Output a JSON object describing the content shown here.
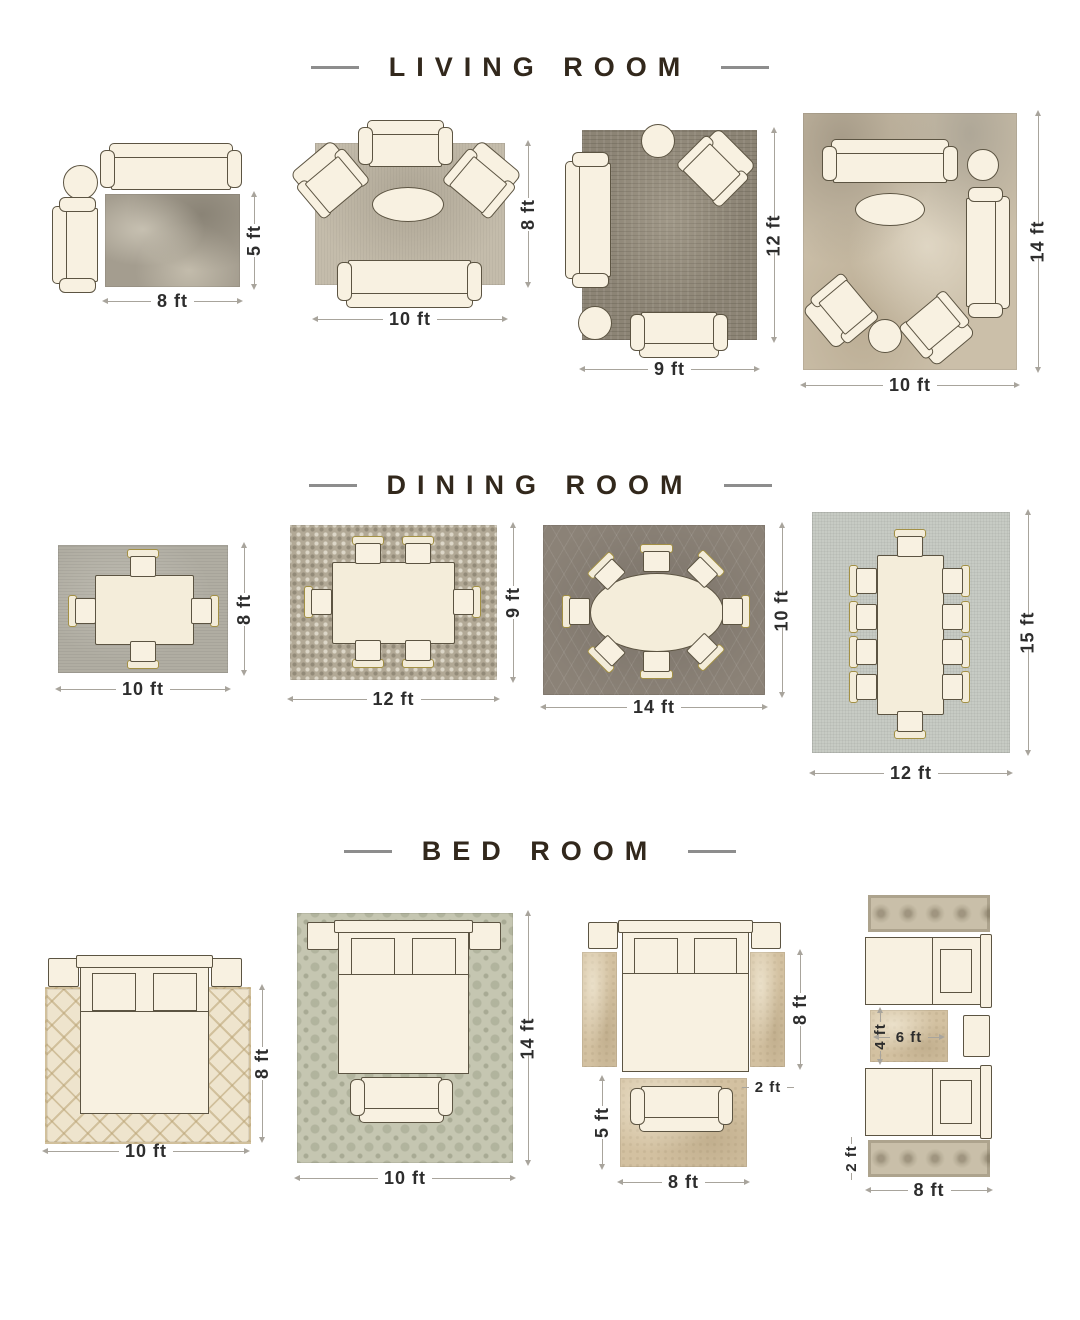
{
  "title": "Rug size guide by room",
  "colors": {
    "page_bg": "#ffffff",
    "heading_text": "#32281c",
    "heading_dash": "#8d8d8d",
    "dim_line": "#a8a49c",
    "dim_text": "#2d2d2d",
    "furniture_fill": "#f8f1e1",
    "furniture_outline": "#5c5442",
    "chair_trim": "#a39044",
    "rug_lr1": "#a49d8f",
    "rug_lr2": "#c4bcab",
    "rug_lr3": "#8c8475",
    "rug_lr4": "#cbbfa9",
    "rug_dr1": "#b0ada2",
    "rug_dr2": "#b2a996",
    "rug_dr3": "#8b8277",
    "rug_dr4": "#c7cbc4",
    "rug_br1": "#eee4cd",
    "rug_br2": "#c5c6b1",
    "rug_br3": "#d3c1a1",
    "rug_br4": "#c9bfa9"
  },
  "sections": [
    {
      "title": "LIVING ROOM",
      "layouts": [
        {
          "furniture": [
            "sofa",
            "chaise",
            "round-side-table",
            "rug"
          ],
          "labels": {
            "width": "8 ft",
            "height": "5 ft"
          }
        },
        {
          "furniture": [
            "loveseat",
            "armchair",
            "armchair",
            "oval-coffee-table",
            "sofa",
            "rug"
          ],
          "labels": {
            "width": "10 ft",
            "height": "8 ft"
          }
        },
        {
          "furniture": [
            "sofa",
            "round-side-table",
            "armchair",
            "stool",
            "bench",
            "rug"
          ],
          "labels": {
            "width": "9 ft",
            "height": "12 ft"
          }
        },
        {
          "furniture": [
            "sofa",
            "round-side-table",
            "oval-coffee-table",
            "sofa",
            "armchair",
            "armchair",
            "stool",
            "rug"
          ],
          "labels": {
            "width": "10 ft",
            "height": "14 ft"
          }
        }
      ]
    },
    {
      "title": "DINING ROOM",
      "layouts": [
        {
          "furniture": [
            "dining-table",
            "4-chairs",
            "rug"
          ],
          "labels": {
            "width": "10 ft",
            "height": "8 ft"
          }
        },
        {
          "furniture": [
            "dining-table",
            "6-chairs",
            "rug"
          ],
          "labels": {
            "width": "12 ft",
            "height": "9 ft"
          }
        },
        {
          "furniture": [
            "oval-dining-table",
            "8-chairs",
            "rug"
          ],
          "labels": {
            "width": "14 ft",
            "height": "10 ft"
          }
        },
        {
          "furniture": [
            "long-dining-table",
            "10-chairs",
            "rug"
          ],
          "labels": {
            "width": "12 ft",
            "height": "15 ft"
          }
        }
      ]
    },
    {
      "title": "BED ROOM",
      "layouts": [
        {
          "furniture": [
            "bed",
            "nightstand",
            "nightstand",
            "rug"
          ],
          "labels": {
            "width": "10 ft",
            "height": "8 ft"
          }
        },
        {
          "furniture": [
            "bed",
            "nightstand",
            "nightstand",
            "bench",
            "rug"
          ],
          "labels": {
            "width": "10 ft",
            "height": "14 ft"
          }
        },
        {
          "furniture": [
            "bed",
            "nightstand",
            "nightstand",
            "runner-rug",
            "runner-rug",
            "bench",
            "foot-rug"
          ],
          "labels": {
            "bed_side": "8 ft",
            "runner_width": "2 ft",
            "foot_rug_height": "5 ft",
            "width": "8 ft"
          }
        },
        {
          "furniture": [
            "twin-bed",
            "twin-bed",
            "nightstand",
            "accent-rug",
            "runner-rug",
            "runner-rug"
          ],
          "labels": {
            "accent_rug_height": "4 ft",
            "accent_rug_width": "6 ft",
            "runner_height": "2 ft",
            "width": "8 ft"
          }
        }
      ]
    }
  ]
}
